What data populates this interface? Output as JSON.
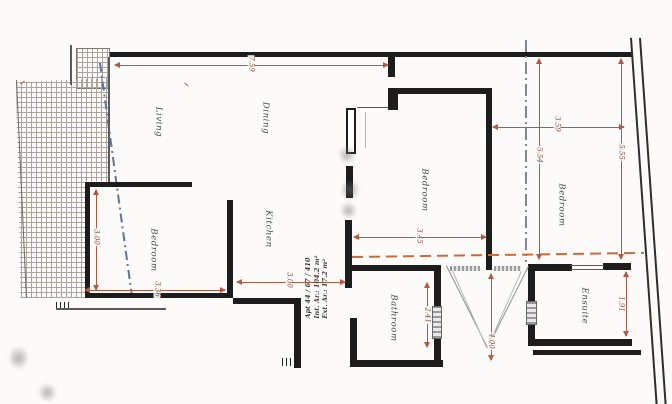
{
  "title": "Apartment floor plan drawing",
  "rooms": {
    "living": "Living",
    "dining": "Dining",
    "kitchen": "Kitchen",
    "bedroom_left": "Bedroom",
    "bedroom_middle": "Bedroom",
    "bedroom_right": "Bedroom",
    "bathroom": "Bathroom",
    "ensuite": "Ensuite"
  },
  "dimensions": {
    "top_width": "7.59",
    "bedroom_right_width": "3.59",
    "bedroom_right_depth_inner": "5.54",
    "bedroom_right_depth_outer": "5.55",
    "bedroom_middle_width": "3.45",
    "bedroom_left_height": "3.00",
    "bedroom_left_width": "3.36",
    "kitchen_width": "3.00",
    "bathroom_height": "2.41",
    "void_depth": "4.00",
    "ensuite_depth": "1.91"
  },
  "apartment_info": {
    "line1": "Apt 44 / 67 / 410",
    "line2": "Int. Ar.: 104.2 m²",
    "line3": "Ext. Ar.: 17.2 m²"
  },
  "colors": {
    "wall": "#1d1d1d",
    "dimension": "#b05a45",
    "boundary_dash_orange": "#c96a3d",
    "terrace_dash_blue": "#5a76a0",
    "demise_dash_gray": "#7e8791",
    "room_label": "#474747"
  }
}
